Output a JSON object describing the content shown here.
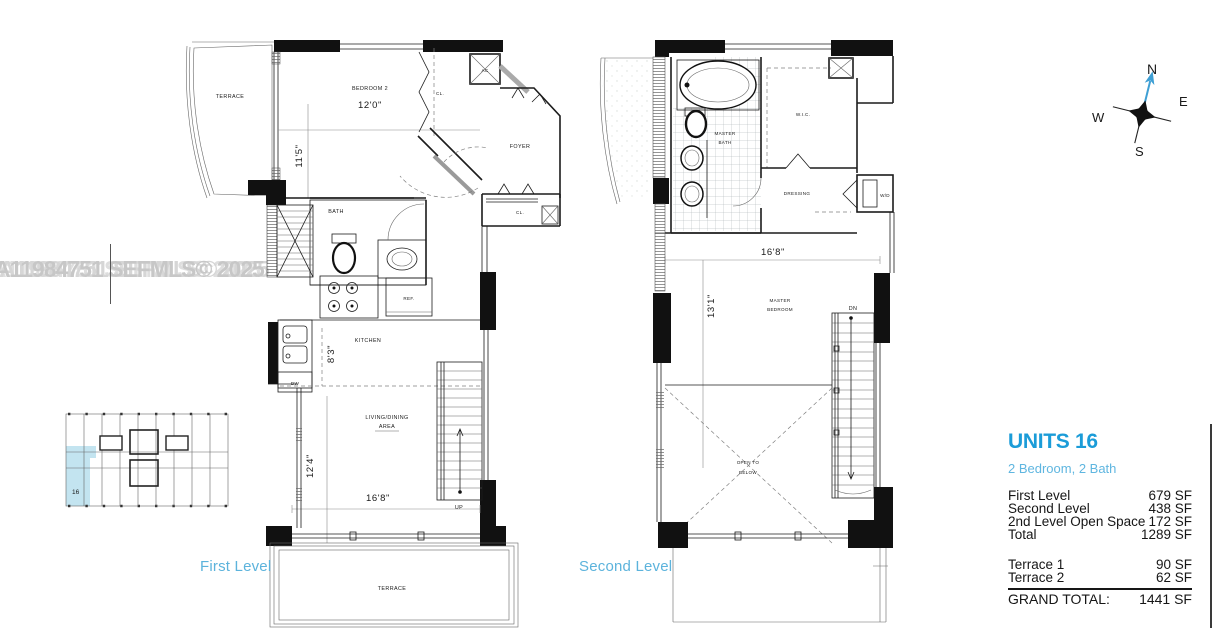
{
  "watermark": "A11984751 SEFMLS© 2025",
  "colors": {
    "accent_blue": "#1b9cd8",
    "light_blue": "#5fb6e0",
    "unit_highlight": "#c3e4f0"
  },
  "compass": {
    "north": "N",
    "east": "E",
    "south": "S",
    "west": "W"
  },
  "key_plan": {
    "highlighted_unit": "16"
  },
  "first_level": {
    "caption": "First Level",
    "rooms": {
      "terrace_top": "TERRACE",
      "bedroom2": "BEDROOM 2",
      "bedroom2_width": "12'0\"",
      "bedroom2_depth": "11'5\"",
      "closet_upper": "CL.",
      "ac": "AC",
      "foyer": "FOYER",
      "closet_lower": "CL.",
      "bath": "BATH",
      "kitchen": "KITCHEN",
      "kitchen_dim": "8'3\"",
      "fridge": "REF.",
      "dishwasher": "DW",
      "living_1": "LIVING/DINING",
      "living_2": "AREA",
      "living_depth": "12'4\"",
      "living_width": "16'8\"",
      "up": "UP",
      "terrace_bottom": "TERRACE"
    }
  },
  "second_level": {
    "caption": "Second Level",
    "rooms": {
      "master_bath_1": "MASTER",
      "master_bath_2": "BATH",
      "wic": "W.I.C.",
      "dressing": "DRESSING",
      "washer_dryer": "W/D",
      "master_width": "16'8\"",
      "master_depth": "13'1\"",
      "master_bedroom_1": "MASTER",
      "master_bedroom_2": "BEDROOM",
      "dn": "DN",
      "open_below_1": "OPEN TO",
      "open_below_2": "BELOW"
    }
  },
  "info_panel": {
    "title": "UNITS 16",
    "subtitle": "2 Bedroom, 2 Bath",
    "rows": [
      {
        "label": "First Level",
        "value": "679 SF"
      },
      {
        "label": "Second Level",
        "value": "438 SF"
      },
      {
        "label": "2nd Level Open Space",
        "value": "172 SF"
      },
      {
        "label": "Total",
        "value": "1289 SF"
      }
    ],
    "terrace_rows": [
      {
        "label": "Terrace 1",
        "value": "90 SF"
      },
      {
        "label": "Terrace 2",
        "value": "62 SF"
      }
    ],
    "grand_total_label": "GRAND TOTAL:",
    "grand_total_value": "1441 SF"
  }
}
